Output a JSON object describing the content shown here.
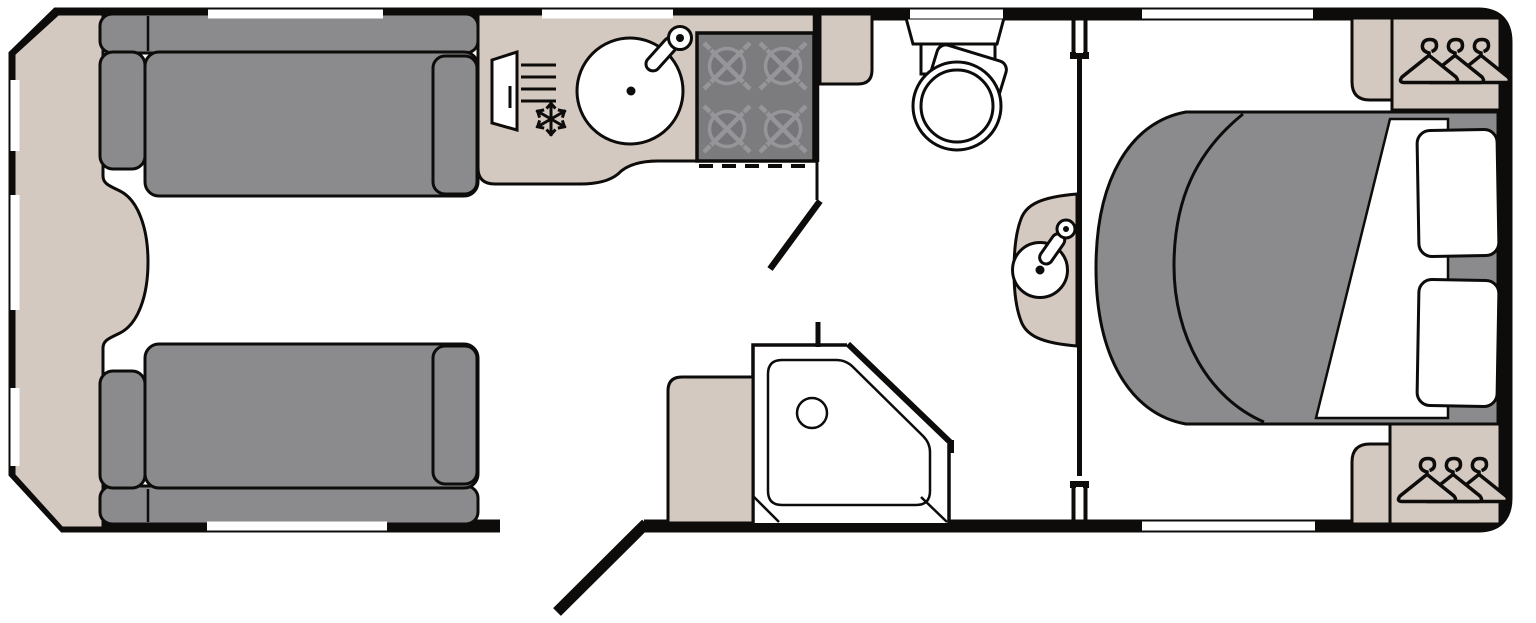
{
  "title": "Caravan Floor Plan",
  "colors": {
    "outline": "#0d0c0a",
    "upholstery_gray": "#8b8b8e",
    "furniture_beige": "#d3c9c0",
    "hob_gray": "#7c7c7f",
    "burner_gray": "#76767a",
    "burner_ring_gray": "#96969a",
    "floor_white": "#ffffff"
  },
  "areas": {
    "front_lounge": {
      "label": "Front lounge with two facing sofas and front chest",
      "items": [
        "front-chest",
        "sofa-top",
        "sofa-bottom"
      ]
    },
    "kitchen": {
      "label": "Kitchen with worktop, round sink, fridge freezer and 4-burner hob",
      "items": [
        "worktop",
        "sink",
        "tap",
        "fridge-freezer",
        "hob"
      ]
    },
    "washroom": {
      "label": "Washroom with toilet, corner shower, washbasin and cabinets",
      "items": [
        "toilet",
        "corner-shower",
        "washbasin",
        "vanity",
        "cabinet"
      ]
    },
    "bedroom": {
      "label": "Rear bedroom with island double bed, pillows and wardrobes",
      "items": [
        "island-bed",
        "duvet",
        "pillow",
        "pillow",
        "wardrobe-top",
        "wardrobe-bottom"
      ]
    }
  },
  "openings": {
    "entrance_door": {
      "label": "Entrance door (shown open)",
      "state": "open",
      "count": 1
    },
    "interior_doors": {
      "label": "Washroom and bedroom door jambs",
      "count": 2
    },
    "windows": {
      "label": "Windows",
      "top_count": 4,
      "bottom_count": 2,
      "front_count": 3,
      "total": 9
    }
  },
  "icons": {
    "hangers": {
      "label": "hanger-icon",
      "per_wardrobe": 3,
      "wardrobes": 2
    },
    "snowflake": {
      "label": "snowflake-icon (freezer)"
    },
    "burners": {
      "label": "burner-icon",
      "count": 4
    }
  }
}
